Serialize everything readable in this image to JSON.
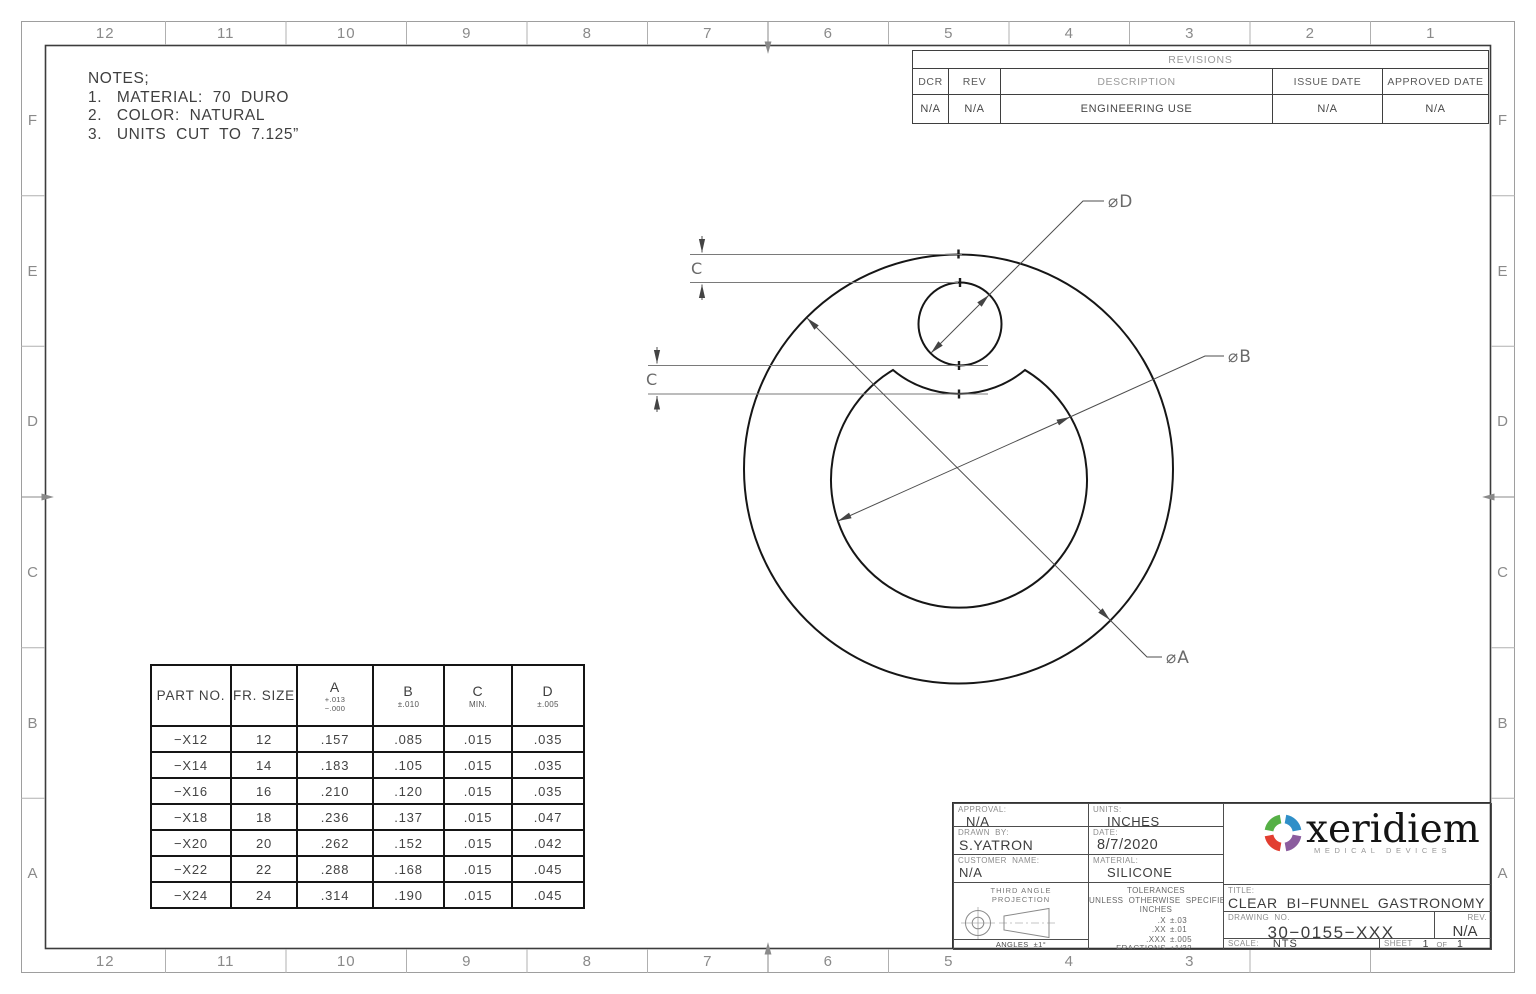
{
  "sheet": {
    "top_zones": [
      "12",
      "11",
      "10",
      "9",
      "8",
      "7",
      "6",
      "5",
      "4",
      "3",
      "2",
      "1"
    ],
    "bottom_zones": [
      "12",
      "11",
      "10",
      "9",
      "8",
      "7",
      "6",
      "5",
      "4",
      "3",
      "",
      ""
    ],
    "side_zones": [
      "F",
      "E",
      "D",
      "C",
      "B",
      "A"
    ]
  },
  "notes": {
    "title": "NOTES;",
    "items": [
      "1.   MATERIAL:  70  DURO",
      "2.   COLOR:  NATURAL",
      "3.   UNITS  CUT  TO  7.125”"
    ]
  },
  "revisions": {
    "title": "REVISIONS",
    "headers": {
      "dcr": "DCR",
      "rev": "REV",
      "description": "DESCRIPTION",
      "issue_date": "ISSUE DATE",
      "approved_date": "APPROVED DATE"
    },
    "row": {
      "dcr": "N/A",
      "rev": "N/A",
      "description": "ENGINEERING USE",
      "issue_date": "N/A",
      "approved_date": "N/A"
    }
  },
  "dims": {
    "dia_d": "⌀D",
    "dia_b": "⌀B",
    "dia_a": "⌀A",
    "c_upper": "C",
    "c_lower": "C"
  },
  "size_table": {
    "col_part": "PART  NO.",
    "col_fr": "FR.  SIZE",
    "col_a": "A",
    "col_a_tol_plus": "+.013",
    "col_a_tol_minus": "−.000",
    "col_b": "B",
    "col_b_tol": "±.010",
    "col_c": "C",
    "col_c_tol": "MIN.",
    "col_d": "D",
    "col_d_tol": "±.005",
    "rows": [
      [
        "−X12",
        "12",
        ".157",
        ".085",
        ".015",
        ".035"
      ],
      [
        "−X14",
        "14",
        ".183",
        ".105",
        ".015",
        ".035"
      ],
      [
        "−X16",
        "16",
        ".210",
        ".120",
        ".015",
        ".035"
      ],
      [
        "−X18",
        "18",
        ".236",
        ".137",
        ".015",
        ".047"
      ],
      [
        "−X20",
        "20",
        ".262",
        ".152",
        ".015",
        ".042"
      ],
      [
        "−X22",
        "22",
        ".288",
        ".168",
        ".015",
        ".045"
      ],
      [
        "−X24",
        "24",
        ".314",
        ".190",
        ".015",
        ".045"
      ]
    ]
  },
  "title_block": {
    "approval_label": "APPROVAL:",
    "approval": "N/A",
    "units_label": "UNITS:",
    "units": "INCHES",
    "drawn_by_label": "DRAWN  BY:",
    "drawn_by": "S.YATRON",
    "date_label": "DATE:",
    "date": "8/7/2020",
    "customer_label": "CUSTOMER  NAME:",
    "customer": "N/A",
    "material_label": "MATERIAL:",
    "material": "SILICONE",
    "projection_line1": "THIRD ANGLE",
    "projection_line2": "PROJECTION",
    "angles": "ANGLES  ±1°",
    "tol_title": "TOLERANCES",
    "tol_line2": "UNLESS  OTHERWISE  SPECIFIED",
    "tol_line3": "INCHES",
    "tol_rows": [
      {
        "dim": ".X",
        "val": "±.03"
      },
      {
        "dim": ".XX",
        "val": "±.01"
      },
      {
        "dim": ".XXX",
        "val": "±.005"
      },
      {
        "dim": "FRACTIONS",
        "val": "±1/32"
      }
    ],
    "company_name": "xeridiem",
    "company_tagline": "MEDICAL DEVICES",
    "phone": "Ph:  520−882−7794",
    "address": "4700  S.  Overland  Drive,  Tucson,  AZ  85714",
    "title_label": "TITLE:",
    "title": "CLEAR  BI−FUNNEL  GASTRONOMY  TUBE",
    "drawing_no_label": "DRAWING  NO.",
    "drawing_no": "30−0155−XXX",
    "rev_label": "REV.",
    "rev": "N/A",
    "scale_label": "SCALE:",
    "scale": "NTS",
    "sheet_label": "SHEET",
    "sheet_num": "1",
    "sheet_of": "OF",
    "sheet_total": "1"
  },
  "colors": {
    "logo_green": "#56B046",
    "logo_blue": "#2F8FC8",
    "logo_purple": "#8B5C9E",
    "logo_red": "#E23E30"
  }
}
